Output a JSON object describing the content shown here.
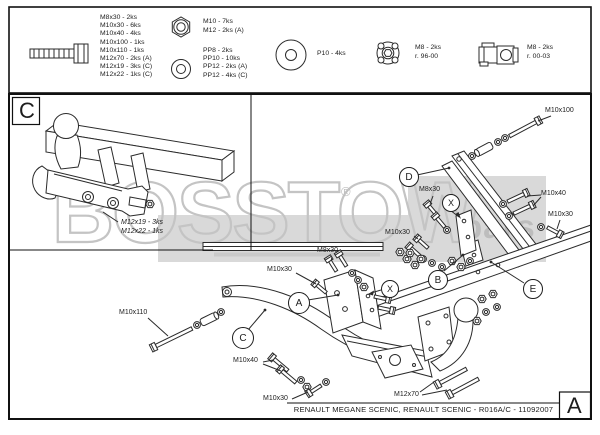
{
  "watermark": {
    "main": "BOSSTOW",
    "sub": "bars",
    "reg": "®"
  },
  "top_box": {
    "bolt_sizes": [
      "M8x30 - 2ks",
      "M10x30 - 6ks",
      "M10x40 - 4ks",
      "M10x100 - 1ks",
      "M10x110 - 1ks",
      "M12x70 - 2ks (A)",
      "M12x19 - 3ks (C)",
      "M12x22 - 1ks (C)"
    ],
    "nut_sizes": [
      "M10 - 7ks",
      "M12 - 2ks (A)"
    ],
    "washer_sizes": [
      "PP8 - 2ks",
      "PP10 - 10ks",
      "PP12 - 2ks (A)",
      "PP12 - 4ks (C)"
    ],
    "plate_washer_label": "P10 - 4ks",
    "flange_nut_lines": [
      "M8 - 2ks",
      "r. 96-00"
    ],
    "cage_nut_lines": [
      "M8 - 2ks",
      "r. 00-03"
    ]
  },
  "diagram": {
    "section_c_label": "C",
    "revision_label": "A",
    "c_annotations": [
      "M12x19 - 3ks",
      "M12x22 - 1ks"
    ],
    "callouts": {
      "a": "A",
      "b": "B",
      "c": "C",
      "d": "D",
      "e": "E",
      "x": "X"
    },
    "part_labels": {
      "m10x100": "M10x100",
      "m8x30": "M8x30",
      "m10x40": "M10x40",
      "m10x30": "M10x30",
      "m10x110": "M10x110",
      "m12x70": "M12x70"
    },
    "title": "RENAULT MEGANE SCENIC, RENAULT SCENIC - R016A/C - 11092007"
  }
}
